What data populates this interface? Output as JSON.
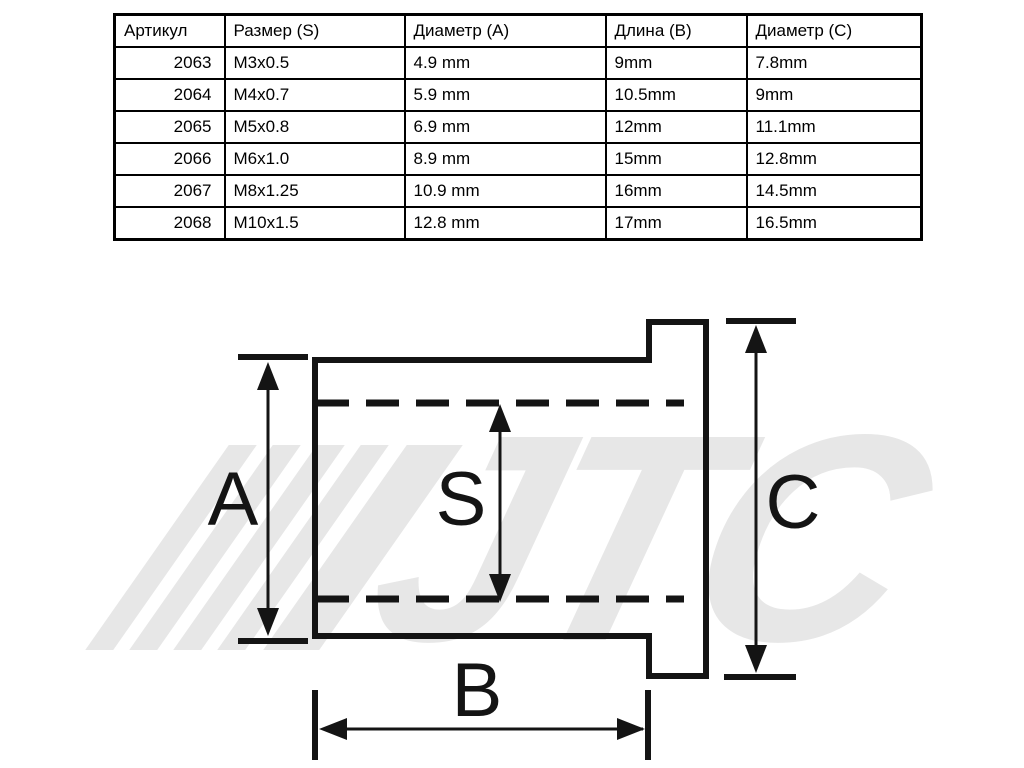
{
  "table": {
    "headers": [
      "Артикул",
      "Размер (S)",
      "Диаметр (A)",
      "Длина (B)",
      "Диаметр (C)"
    ],
    "rows": [
      [
        "2063",
        "M3x0.5",
        "4.9 mm",
        "9mm",
        "7.8mm"
      ],
      [
        "2064",
        "M4x0.7",
        "5.9 mm",
        "10.5mm",
        "9mm"
      ],
      [
        "2065",
        "M5x0.8",
        "6.9 mm",
        "12mm",
        "11.1mm"
      ],
      [
        "2066",
        "M6x1.0",
        "8.9 mm",
        "15mm",
        "12.8mm"
      ],
      [
        "2067",
        "M8x1.25",
        "10.9 mm",
        "16mm",
        "14.5mm"
      ],
      [
        "2068",
        "M10x1.5",
        "12.8 mm",
        "17mm",
        "16.5mm"
      ]
    ]
  },
  "diagram": {
    "labels": {
      "a": "A",
      "s": "S",
      "c": "C",
      "b": "B"
    },
    "watermark": "JTC",
    "colors": {
      "line": "#141414",
      "watermark": "#e7e7e7",
      "background": "#ffffff"
    }
  }
}
